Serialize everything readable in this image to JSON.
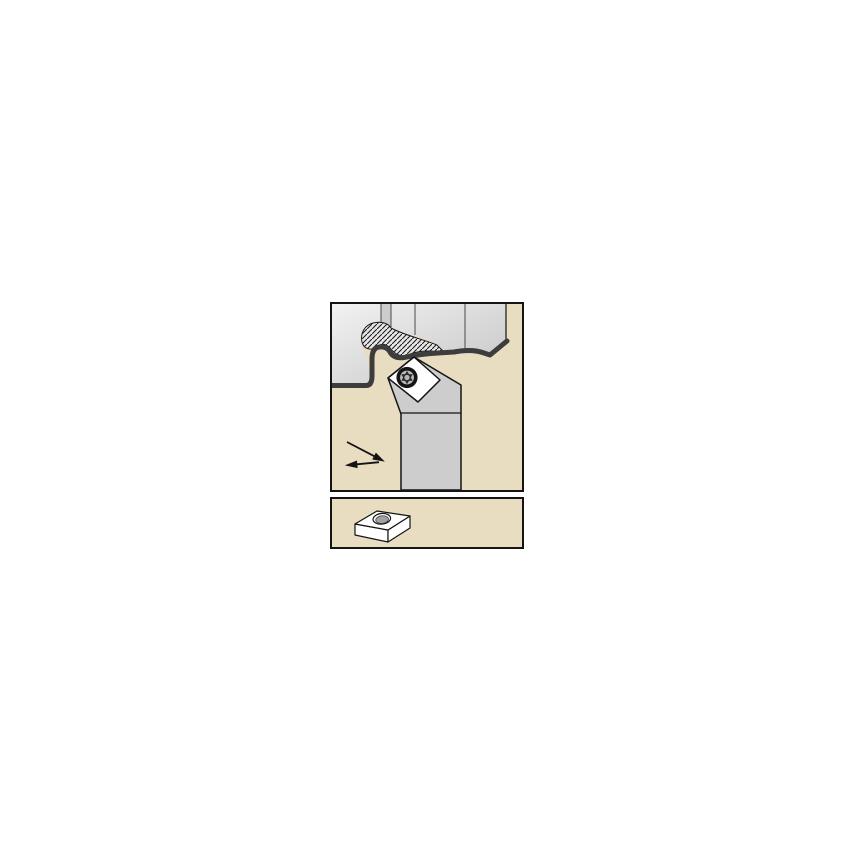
{
  "window": {
    "background_color": "#ffffff"
  },
  "colors": {
    "page_bg": "#ffffff",
    "panel_border": "#141414",
    "panel_bg": "#e8dcc1",
    "workpiece_light": "#f2f2f2",
    "workpiece_dark": "#c4c4c4",
    "workpiece_strip": "#cccccc",
    "facet_line": "#4a4a4a",
    "chip_fill": "#e7e7e7",
    "hatch_line": "#1c1c1c",
    "surface_line": "#3d3d3d",
    "tool_gray": "#cdcdcd",
    "outline": "#141414",
    "insert_white": "#ffffff",
    "screw_dark": "#151515",
    "screw_ring": "#bdbdbd",
    "screw_star": "#2b2b2b",
    "screw_core": "#b5b5b5",
    "hole_gray": "#a2a2a2",
    "arrow_black": "#141414"
  },
  "illustration": {
    "application_panel": {
      "name": "profile-turning-application",
      "elements": [
        "workpiece",
        "curling-chip",
        "machined-surface-line",
        "toolholder-head-and-shank",
        "rhombic-indexable-insert",
        "torx-clamp-screw",
        "feed-direction-arrow"
      ]
    },
    "insert_panel": {
      "name": "rhombic-insert-3d-view",
      "elements": [
        "insert-top-face",
        "insert-side-faces",
        "insert-center-hole"
      ]
    }
  }
}
